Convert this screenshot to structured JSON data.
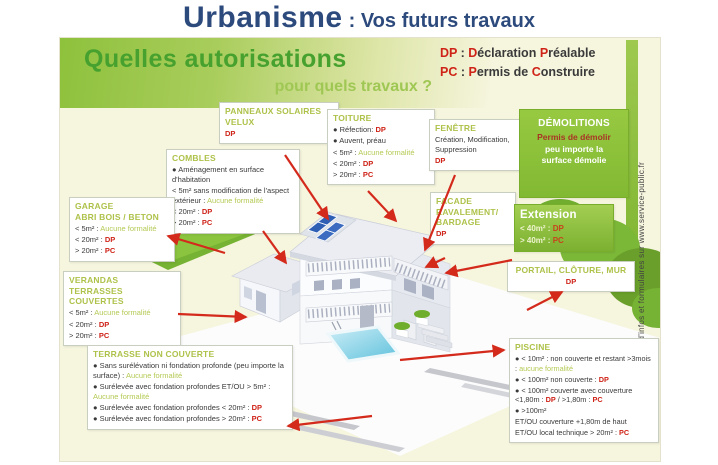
{
  "title": {
    "main": "Urbanisme",
    "sub": ": Vos futurs travaux"
  },
  "legend": {
    "lines": [
      {
        "segments": [
          {
            "t": "DP",
            "c": "red"
          },
          {
            "t": " : ",
            "c": "dark"
          },
          {
            "t": "D",
            "c": "red"
          },
          {
            "t": "éclaration ",
            "c": "dark"
          },
          {
            "t": "P",
            "c": "red"
          },
          {
            "t": "réalable",
            "c": "dark"
          }
        ]
      },
      {
        "segments": [
          {
            "t": "PC",
            "c": "red"
          },
          {
            "t": " : ",
            "c": "dark"
          },
          {
            "t": "P",
            "c": "red"
          },
          {
            "t": "ermis de ",
            "c": "dark"
          },
          {
            "t": "C",
            "c": "red"
          },
          {
            "t": "onstruire",
            "c": "dark"
          }
        ]
      }
    ]
  },
  "banner": {
    "line1": "Quelles autorisations",
    "line2": "pour quels travaux ?"
  },
  "boxes": {
    "panneaux": {
      "title": "PANNEAUX SOLAIRES VELUX",
      "lines": [
        {
          "segments": [
            {
              "t": "DP",
              "c": "red"
            }
          ]
        }
      ]
    },
    "toiture": {
      "title": "TOITURE",
      "lines": [
        {
          "segments": [
            {
              "t": "● Réfection: ",
              "c": "dark"
            },
            {
              "t": "DP",
              "c": "red"
            }
          ]
        },
        {
          "segments": [
            {
              "t": "● Auvent, préau",
              "c": "dark"
            }
          ]
        },
        {
          "segments": [
            {
              "t": "< 5m² : ",
              "c": "dark"
            },
            {
              "t": "Aucune formalité",
              "c": "green"
            }
          ]
        },
        {
          "segments": [
            {
              "t": "< 20m² : ",
              "c": "dark"
            },
            {
              "t": "DP",
              "c": "red"
            }
          ]
        },
        {
          "segments": [
            {
              "t": "> 20m² : ",
              "c": "dark"
            },
            {
              "t": "PC",
              "c": "red"
            }
          ]
        }
      ]
    },
    "fenetre": {
      "title": "FENÊTRE",
      "lines": [
        {
          "segments": [
            {
              "t": "Création, Modification, Suppression",
              "c": "dark"
            }
          ]
        },
        {
          "segments": [
            {
              "t": "DP",
              "c": "red"
            }
          ]
        }
      ]
    },
    "demolitions": {
      "title": "DÉMOLITIONS",
      "lines": [
        {
          "segments": [
            {
              "t": "Permis de démolir",
              "c": "darkred"
            }
          ]
        },
        {
          "segments": [
            {
              "t": "peu importe la surface démolie",
              "c": "white"
            }
          ]
        }
      ]
    },
    "combles": {
      "title": "COMBLES",
      "lines": [
        {
          "segments": [
            {
              "t": "● Aménagement en surface d'habitation",
              "c": "dark"
            }
          ]
        },
        {
          "segments": [
            {
              "t": "< 5m² sans modification de l'aspect extérieur : ",
              "c": "dark"
            },
            {
              "t": "Aucune formalité",
              "c": "green"
            }
          ]
        },
        {
          "segments": [
            {
              "t": "< 20m² : ",
              "c": "dark"
            },
            {
              "t": "DP",
              "c": "red"
            }
          ]
        },
        {
          "segments": [
            {
              "t": "> 20m² : ",
              "c": "dark"
            },
            {
              "t": "PC",
              "c": "red"
            }
          ]
        }
      ]
    },
    "garage": {
      "title": "GARAGE",
      "title2": "ABRI BOIS / BETON",
      "lines": [
        {
          "segments": [
            {
              "t": "< 5m² : ",
              "c": "dark"
            },
            {
              "t": "Aucune formalité",
              "c": "green"
            }
          ]
        },
        {
          "segments": [
            {
              "t": "< 20m² : ",
              "c": "dark"
            },
            {
              "t": "DP",
              "c": "red"
            }
          ]
        },
        {
          "segments": [
            {
              "t": "> 20m² : ",
              "c": "dark"
            },
            {
              "t": "PC",
              "c": "red"
            }
          ]
        }
      ]
    },
    "verandas": {
      "title": "VERANDAS",
      "title2": "TERRASSES COUVERTES",
      "lines": [
        {
          "segments": [
            {
              "t": "< 5m² : ",
              "c": "dark"
            },
            {
              "t": "Aucune formalité",
              "c": "green"
            }
          ]
        },
        {
          "segments": [
            {
              "t": "< 20m² : ",
              "c": "dark"
            },
            {
              "t": "DP",
              "c": "red"
            }
          ]
        },
        {
          "segments": [
            {
              "t": "> 20m² : ",
              "c": "dark"
            },
            {
              "t": "PC",
              "c": "red"
            }
          ]
        }
      ]
    },
    "facade": {
      "title": "FACADE",
      "title2": "RAVALEMENT/ BARDAGE",
      "lines": [
        {
          "segments": [
            {
              "t": "DP",
              "c": "red"
            }
          ]
        }
      ]
    },
    "extension": {
      "title": "Extension",
      "lines": [
        {
          "segments": [
            {
              "t": "< 40m² : ",
              "c": "pale"
            },
            {
              "t": "DP",
              "c": "orange"
            }
          ]
        },
        {
          "segments": [
            {
              "t": "> 40m² : ",
              "c": "pale"
            },
            {
              "t": "PC",
              "c": "orange"
            }
          ]
        }
      ]
    },
    "portail": {
      "title": "PORTAIL, CLÔTURE, MUR",
      "lines": [
        {
          "segments": [
            {
              "t": "DP",
              "c": "red"
            }
          ]
        }
      ]
    },
    "terrasse": {
      "title": "TERRASSE NON COUVERTE",
      "lines": [
        {
          "segments": [
            {
              "t": "● Sans surélévation ni fondation profonde (peu importe la surface) : ",
              "c": "dark"
            },
            {
              "t": "Aucune formalité",
              "c": "green"
            }
          ]
        },
        {
          "segments": [
            {
              "t": "● Surélevée avec fondation profondes ET/OU > 5m² : ",
              "c": "dark"
            },
            {
              "t": "Aucune formalité",
              "c": "green"
            }
          ]
        },
        {
          "segments": [
            {
              "t": "● Surélevée avec fondation profondes < 20m² : ",
              "c": "dark"
            },
            {
              "t": "DP",
              "c": "red"
            }
          ]
        },
        {
          "segments": [
            {
              "t": "● Surélevée avec fondation profondes > 20m² : ",
              "c": "dark"
            },
            {
              "t": "PC",
              "c": "red"
            }
          ]
        }
      ]
    },
    "piscine": {
      "title": "PISCINE",
      "lines": [
        {
          "segments": [
            {
              "t": "● < 10m² : non couverte et restant >3mois : ",
              "c": "dark"
            },
            {
              "t": "aucune formalité",
              "c": "green"
            }
          ]
        },
        {
          "segments": [
            {
              "t": "● < 100m² non couverte : ",
              "c": "dark"
            },
            {
              "t": "DP",
              "c": "red"
            }
          ]
        },
        {
          "segments": [
            {
              "t": "● < 100m² couverte avec couverture <1,80m : ",
              "c": "dark"
            },
            {
              "t": "DP",
              "c": "red"
            },
            {
              "t": " / >1,80m : ",
              "c": "dark"
            },
            {
              "t": "PC",
              "c": "red"
            }
          ]
        },
        {
          "segments": [
            {
              "t": "● >100m²",
              "c": "dark"
            }
          ]
        },
        {
          "segments": [
            {
              "t": "ET/OU couverture +1,80m de haut",
              "c": "dark"
            }
          ]
        },
        {
          "segments": [
            {
              "t": "ET/OU local technique > 20m² : ",
              "c": "dark"
            },
            {
              "t": "PC",
              "c": "red"
            }
          ]
        }
      ]
    }
  },
  "sidebar": {
    "info": "+ d'infos et formulaires sur www.service-public.fr"
  },
  "colors": {
    "accent_green": "#8cc63e",
    "box_title_green": "#aec24a",
    "permit_red": "#cf2318",
    "title_blue": "#2d4a7d",
    "poster_cream": "#f6f5de"
  }
}
